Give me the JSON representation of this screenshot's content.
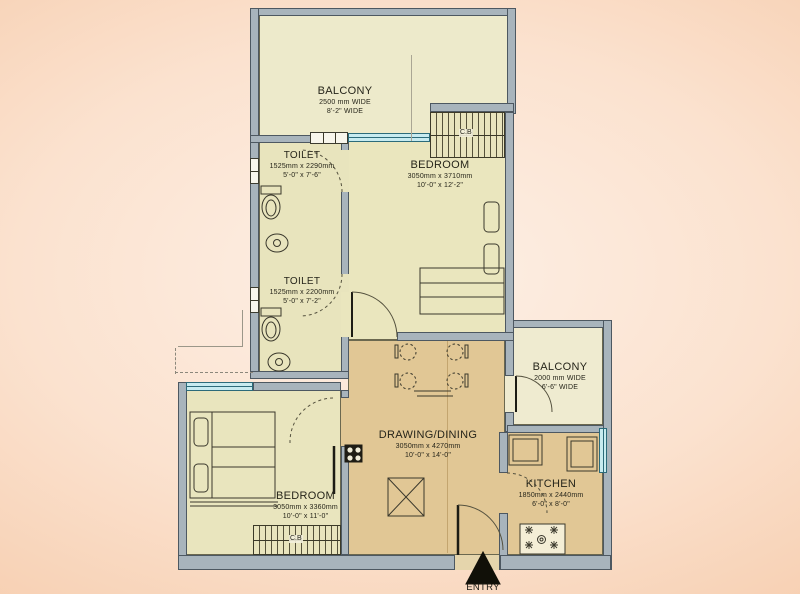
{
  "page": {
    "type": "apartment-floor-plan"
  },
  "entry": {
    "label": "ENTRY"
  },
  "wardrobe": {
    "label": "C.B"
  },
  "rooms": {
    "balcony_top": {
      "name": "BALCONY",
      "size_mm": "2500 mm WIDE",
      "size_ft": "8'-2\" WIDE"
    },
    "toilet_1": {
      "name": "TOILET",
      "size_mm": "1525mm x 2290mm",
      "size_ft": "5'-0\" x 7'-6\""
    },
    "toilet_2": {
      "name": "TOILET",
      "size_mm": "1525mm x 2200mm",
      "size_ft": "5'-0\" x 7'-2\""
    },
    "bedroom_top": {
      "name": "BEDROOM",
      "size_mm": "3050mm x 3710mm",
      "size_ft": "10'-0\" x 12'-2\""
    },
    "balcony_right": {
      "name": "BALCONY",
      "size_mm": "2000 mm WIDE",
      "size_ft": "6'-6\" WIDE"
    },
    "drawing_dining": {
      "name": "DRAWING/DINING",
      "size_mm": "3050mm x 4270mm",
      "size_ft": "10'-0\" x 14'-0\""
    },
    "kitchen": {
      "name": "KITCHEN",
      "size_mm": "1850mm x 2440mm",
      "size_ft": "6'-0\" x 8'-0\""
    },
    "bedroom_bottom": {
      "name": "BEDROOM",
      "size_mm": "3050mm x 3360mm",
      "size_ft": "10'-0\" x 11'-0\""
    }
  },
  "colors": {
    "background": "#f6cbab",
    "floor_pale": "#eae6bf",
    "floor_tan": "#e1c795",
    "balcony_cream": "#efebd0",
    "wall": "#a8b4bc",
    "window_glass": "#c7ebf0"
  }
}
